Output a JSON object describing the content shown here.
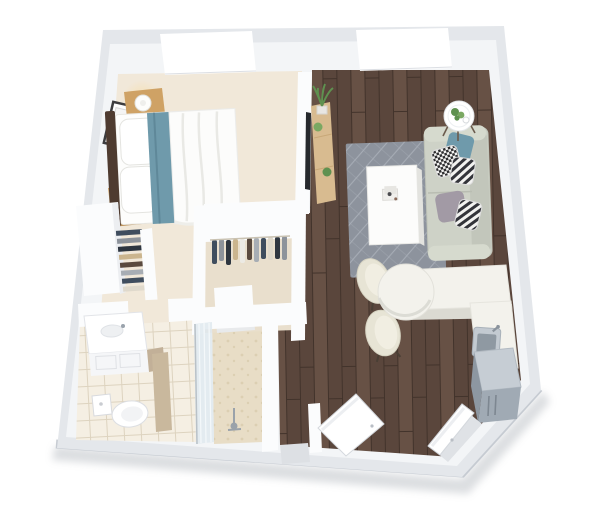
{
  "image_type": "3d-floorplan-render",
  "background": "#ffffff",
  "palette": {
    "wall_outer": "#e4e7eb",
    "wall_top": "#f3f5f7",
    "wall_white": "#fbfcfd",
    "wall_rim": "#c6cbd2",
    "bedroom_carpet": "#f1e8d9",
    "closet_floor": "#e9dfcd",
    "wood_plank_a": "#5a463c",
    "wood_plank_b": "#4e3c33",
    "wood_plank_c": "#675145",
    "wood_seam": "#42332b",
    "tile_floor": "#f5efe3",
    "tile_line": "#ddd3bf",
    "shower_floor": "#e8ddc6",
    "shower_dot": "#dccfb2",
    "shower_glass": "#dfe9ee",
    "rug": "#8d939d",
    "rug_line": "#a8aeb7",
    "bed_linen": "#fdfdfc",
    "headboard": "#4e3b30",
    "oak": "#cfa265",
    "console_oak": "#d8bb90",
    "pillow_teal": "#6f9aab",
    "sofa": "#ced2c7",
    "sofa_dark": "#c2c6bb",
    "sofa_light": "#d6dace",
    "pillow_gray": "#a29aa5",
    "counter": "#f3f2ec",
    "counter_side": "#dbdad2",
    "chair_cream": "#e7e4d5",
    "chair_inner": "#f1eee2",
    "steel": "#a0aab4",
    "steel_light": "#c6cdd4",
    "plant_green": "#5f9150",
    "plant_green2": "#7aa862",
    "tv_dark": "#26292d",
    "lamp_glow": "#f6dfae",
    "clothes": [
      "#3f4d5e",
      "#8d939b",
      "#cbb58e",
      "#eceae4",
      "#2e3640",
      "#a7adb4",
      "#5a4a3f",
      "#dfd9cc"
    ]
  },
  "rooms": [
    {
      "id": "bedroom",
      "label": "Bedroom",
      "furniture": [
        "double-bed",
        "headboard",
        "pillows",
        "teal-throw",
        "nightstand-upper",
        "nightstand-lower",
        "table-lamp-upper",
        "table-lamp-lower",
        "wall-art",
        "window"
      ]
    },
    {
      "id": "closet",
      "label": "Walk-in closet",
      "furniture": [
        "hanging-clothes",
        "open-wardrobe",
        "island-counter"
      ]
    },
    {
      "id": "bathroom",
      "label": "Bathroom",
      "furniture": [
        "vanity-sink",
        "toilet",
        "walk-in-shower",
        "glass-partition",
        "shower-fixture"
      ]
    },
    {
      "id": "living-room",
      "label": "Living room",
      "furniture": [
        "sofa",
        "throw-pillows",
        "coffee-table",
        "area-rug",
        "round-side-table",
        "potted-plants",
        "wall-tv",
        "media-console",
        "window"
      ]
    },
    {
      "id": "kitchen",
      "label": "Kitchen",
      "furniture": [
        "l-shaped-counter",
        "round-breakfast-counter",
        "dining-chair-1",
        "dining-chair-2",
        "kitchen-sink",
        "refrigerator"
      ]
    },
    {
      "id": "entry",
      "label": "Entry",
      "furniture": [
        "entry-door-open",
        "hall-door-open",
        "door-thresholds"
      ]
    }
  ]
}
